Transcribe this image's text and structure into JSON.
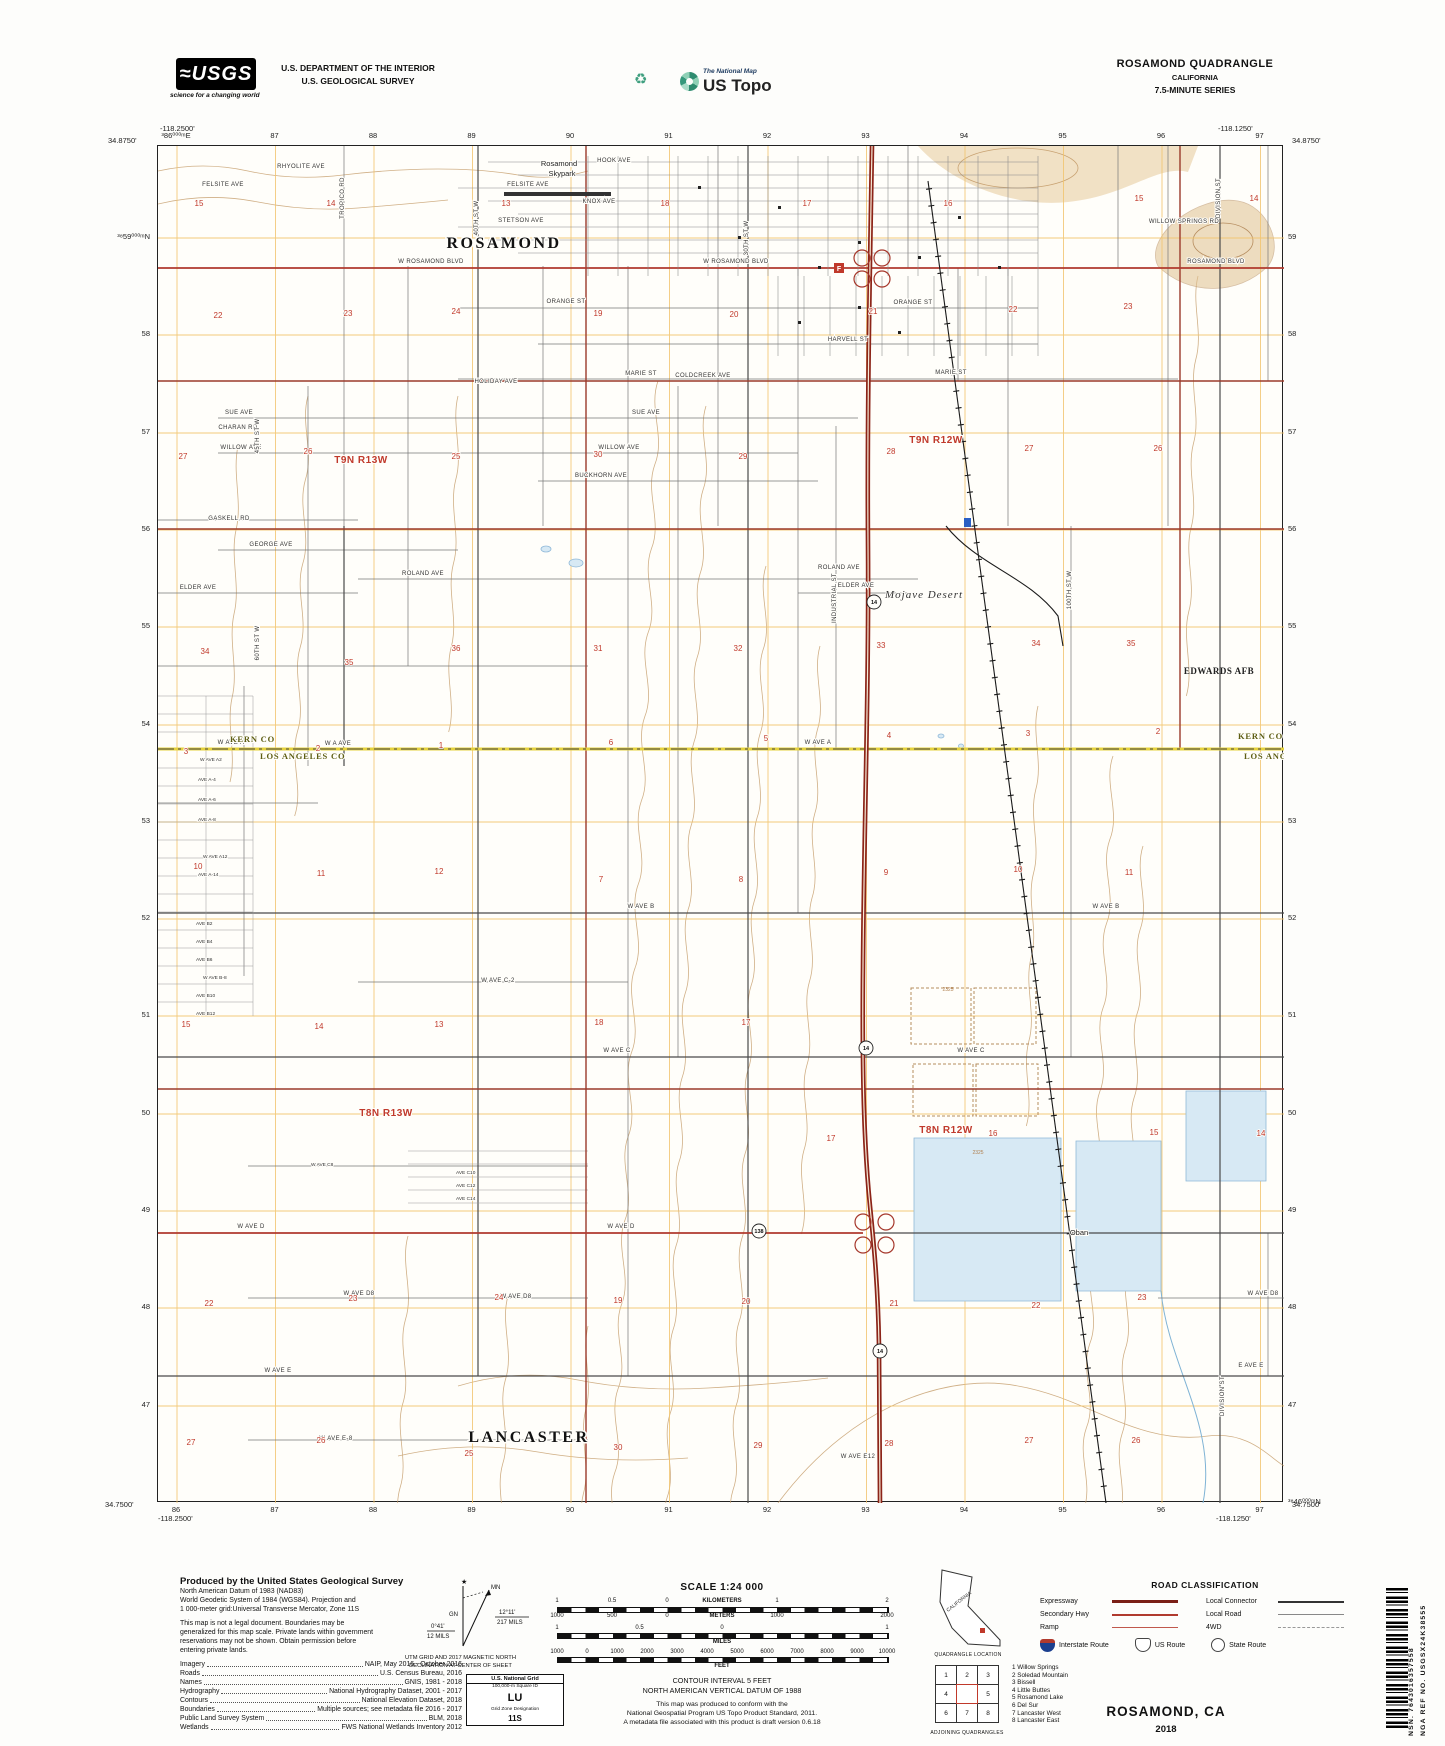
{
  "header": {
    "usgs_logo": "≈USGS",
    "usgs_tagline": "science for a changing world",
    "dept_line1": "U.S. DEPARTMENT OF THE INTERIOR",
    "dept_line2": "U.S. GEOLOGICAL SURVEY",
    "recycle_icon": "♻",
    "natmap_small": "The National Map",
    "natmap_big": "US Topo",
    "quad_title": "ROSAMOND QUADRANGLE",
    "quad_state": "CALIFORNIA",
    "quad_series": "7.5-MINUTE SERIES"
  },
  "map": {
    "corners": {
      "tl_lon": "-118.2500'",
      "tl_lat": "34.8750'",
      "tr_lon": "-118.1250'",
      "tr_lat": "34.8750'",
      "bl_lat": "34.7500'",
      "bl_lon": "-118.2500'",
      "br_lat": "34.7500'",
      "br_lon": "-118.1250'"
    },
    "grid_top": [
      "³86⁰⁰⁰ᵐE",
      "87",
      "88",
      "89",
      "90",
      "91",
      "92",
      "93",
      "94",
      "95",
      "96",
      "97"
    ],
    "grid_bottom": [
      "86",
      "87",
      "88",
      "89",
      "90",
      "91",
      "92",
      "93",
      "94",
      "95",
      "96",
      "97"
    ],
    "grid_left": [
      "³⁸59⁰⁰⁰ᵐN",
      "58",
      "57",
      "56",
      "55",
      "54",
      "53",
      "52",
      "51",
      "50",
      "49",
      "48",
      "47"
    ],
    "grid_right": [
      "59",
      "58",
      "57",
      "56",
      "55",
      "54",
      "53",
      "52",
      "51",
      "50",
      "49",
      "48",
      "47",
      "³⁸46⁰⁰⁰ᵐN"
    ],
    "colors": {
      "highway": "#8c2418",
      "secondary_road": "#b03a2e",
      "county_line": "#e6d23c",
      "water": "#d7e9f4",
      "contour": "#c8a272",
      "utm_grid": "#f2c46d",
      "section_number": "#c0392b"
    },
    "labels": [
      {
        "t": "HOOK AVE",
        "x": 456,
        "y": 16,
        "c": "street"
      },
      {
        "t": "RHYOLITE AVE",
        "x": 143,
        "y": 22,
        "c": "street"
      },
      {
        "t": "FELSITE AVE",
        "x": 65,
        "y": 40,
        "c": "street"
      },
      {
        "t": "FELSITE AVE",
        "x": 370,
        "y": 40,
        "c": "street"
      },
      {
        "t": "KNOX AVE",
        "x": 441,
        "y": 57,
        "c": "street"
      },
      {
        "t": "STETSON AVE",
        "x": 363,
        "y": 76,
        "c": "street"
      },
      {
        "t": "W ROSAMOND BLVD",
        "x": 273,
        "y": 117,
        "c": "street"
      },
      {
        "t": "W ROSAMOND BLVD",
        "x": 578,
        "y": 117,
        "c": "street"
      },
      {
        "t": "ROSAMOND BLVD",
        "x": 1058,
        "y": 117,
        "c": "street"
      },
      {
        "t": "WILLOW SPRINGS RD",
        "x": 1026,
        "y": 77,
        "c": "street"
      },
      {
        "t": "ORANGE ST",
        "x": 408,
        "y": 157,
        "c": "street"
      },
      {
        "t": "ORANGE ST",
        "x": 755,
        "y": 158,
        "c": "street"
      },
      {
        "t": "MARIE ST",
        "x": 483,
        "y": 229,
        "c": "street"
      },
      {
        "t": "MARIE ST",
        "x": 793,
        "y": 228,
        "c": "street"
      },
      {
        "t": "HOLIDAY AVE",
        "x": 338,
        "y": 237,
        "c": "street"
      },
      {
        "t": "COLDCREEK AVE",
        "x": 545,
        "y": 231,
        "c": "street"
      },
      {
        "t": "HARVELL ST",
        "x": 690,
        "y": 195,
        "c": "street"
      },
      {
        "t": "SUE AVE",
        "x": 81,
        "y": 268,
        "c": "street"
      },
      {
        "t": "SUE AVE",
        "x": 488,
        "y": 268,
        "c": "street"
      },
      {
        "t": "CHARAN RD",
        "x": 80,
        "y": 283,
        "c": "street"
      },
      {
        "t": "WILLOW AVE",
        "x": 83,
        "y": 303,
        "c": "street"
      },
      {
        "t": "WILLOW AVE",
        "x": 461,
        "y": 303,
        "c": "street"
      },
      {
        "t": "BUCKHORN AVE",
        "x": 443,
        "y": 331,
        "c": "street"
      },
      {
        "t": "GASKELL RD",
        "x": 71,
        "y": 374,
        "c": "street"
      },
      {
        "t": "GEORGE AVE",
        "x": 113,
        "y": 400,
        "c": "street"
      },
      {
        "t": "ROLAND AVE",
        "x": 265,
        "y": 429,
        "c": "street"
      },
      {
        "t": "ROLAND AVE",
        "x": 681,
        "y": 423,
        "c": "street"
      },
      {
        "t": "ELDER AVE",
        "x": 40,
        "y": 443,
        "c": "street"
      },
      {
        "t": "ELDER AVE",
        "x": 698,
        "y": 441,
        "c": "street"
      },
      {
        "t": "W AVE A",
        "x": 73,
        "y": 598,
        "c": "street"
      },
      {
        "t": "W A AVE",
        "x": 180,
        "y": 599,
        "c": "street"
      },
      {
        "t": "W AVE A",
        "x": 660,
        "y": 598,
        "c": "street"
      },
      {
        "t": "W AVE B",
        "x": 483,
        "y": 762,
        "c": "street"
      },
      {
        "t": "W AVE B",
        "x": 948,
        "y": 762,
        "c": "street"
      },
      {
        "t": "W AVE C",
        "x": 459,
        "y": 906,
        "c": "street"
      },
      {
        "t": "W AVE C",
        "x": 813,
        "y": 906,
        "c": "street"
      },
      {
        "t": "W AVE C-2",
        "x": 340,
        "y": 836,
        "c": "street"
      },
      {
        "t": "W AVE D",
        "x": 93,
        "y": 1082,
        "c": "street"
      },
      {
        "t": "W AVE D",
        "x": 463,
        "y": 1082,
        "c": "street"
      },
      {
        "t": "W AVE D8",
        "x": 201,
        "y": 1149,
        "c": "street"
      },
      {
        "t": "W AVE D8",
        "x": 358,
        "y": 1152,
        "c": "street"
      },
      {
        "t": "W AVE D8",
        "x": 1105,
        "y": 1149,
        "c": "street"
      },
      {
        "t": "W AVE E",
        "x": 120,
        "y": 1226,
        "c": "street"
      },
      {
        "t": "E AVE E",
        "x": 1093,
        "y": 1221,
        "c": "street"
      },
      {
        "t": "W AVE E-8",
        "x": 178,
        "y": 1294,
        "c": "street"
      },
      {
        "t": "W AVE E12",
        "x": 700,
        "y": 1312,
        "c": "street"
      },
      {
        "t": "TROPICO RD",
        "x": 186,
        "y": 52,
        "c": "streetv"
      },
      {
        "t": "40TH ST W",
        "x": 320,
        "y": 72,
        "c": "streetv"
      },
      {
        "t": "30TH ST W",
        "x": 590,
        "y": 92,
        "c": "streetv"
      },
      {
        "t": "45TH ST W",
        "x": 101,
        "y": 290,
        "c": "streetv"
      },
      {
        "t": "60TH ST W",
        "x": 101,
        "y": 497,
        "c": "streetv"
      },
      {
        "t": "INDUSTRIAL ST",
        "x": 678,
        "y": 452,
        "c": "streetv"
      },
      {
        "t": "100TH ST W",
        "x": 913,
        "y": 444,
        "c": "streetv"
      },
      {
        "t": "DIVISION ST",
        "x": 1062,
        "y": 52,
        "c": "streetv"
      },
      {
        "t": "DIVISION ST",
        "x": 1066,
        "y": 1250,
        "c": "streetv"
      },
      {
        "t": "ROSAMOND",
        "x": 346,
        "y": 102,
        "c": "town"
      },
      {
        "t": "LANCASTER",
        "x": 371,
        "y": 1296,
        "c": "town"
      },
      {
        "t": "Rosamond",
        "x": 401,
        "y": 20,
        "c": "place"
      },
      {
        "t": "Skypark",
        "x": 404,
        "y": 30,
        "c": "place"
      },
      {
        "t": "Oban",
        "x": 921,
        "y": 1089,
        "c": "place"
      },
      {
        "t": "Mojave Desert",
        "x": 766,
        "y": 452,
        "c": "desert"
      },
      {
        "t": "EDWARDS AFB",
        "x": 1061,
        "y": 528,
        "c": "afb"
      },
      {
        "t": "KERN CO",
        "x": 72,
        "y": 596,
        "c": "county"
      },
      {
        "t": "LOS ANGELES CO",
        "x": 102,
        "y": 613,
        "c": "county"
      },
      {
        "t": "KERN CO",
        "x": 1080,
        "y": 593,
        "c": "county"
      },
      {
        "t": "LOS ANGELES CO",
        "x": 1086,
        "y": 613,
        "c": "county"
      },
      {
        "t": "T9N R13W",
        "x": 203,
        "y": 317,
        "c": "twnshp"
      },
      {
        "t": "T9N R12W",
        "x": 778,
        "y": 297,
        "c": "twnshp"
      },
      {
        "t": "T8N R13W",
        "x": 228,
        "y": 970,
        "c": "twnshp"
      },
      {
        "t": "T8N R12W",
        "x": 788,
        "y": 987,
        "c": "twnshp"
      },
      {
        "t": "W AVE A2",
        "x": 42,
        "y": 615,
        "c": "sub"
      },
      {
        "t": "AVE A-4",
        "x": 40,
        "y": 635,
        "c": "sub"
      },
      {
        "t": "AVE A-6",
        "x": 40,
        "y": 655,
        "c": "sub"
      },
      {
        "t": "AVE A-8",
        "x": 40,
        "y": 675,
        "c": "sub"
      },
      {
        "t": "W AVE A12",
        "x": 45,
        "y": 712,
        "c": "sub"
      },
      {
        "t": "AVE A-14",
        "x": 40,
        "y": 730,
        "c": "sub"
      },
      {
        "t": "AVE B2",
        "x": 38,
        "y": 779,
        "c": "sub"
      },
      {
        "t": "AVE B4",
        "x": 38,
        "y": 797,
        "c": "sub"
      },
      {
        "t": "AVE B6",
        "x": 38,
        "y": 815,
        "c": "sub"
      },
      {
        "t": "W AVE B-8",
        "x": 45,
        "y": 833,
        "c": "sub"
      },
      {
        "t": "AVE B10",
        "x": 38,
        "y": 851,
        "c": "sub"
      },
      {
        "t": "AVE B12",
        "x": 38,
        "y": 869,
        "c": "sub"
      },
      {
        "t": "W AVE C8",
        "x": 153,
        "y": 1020,
        "c": "sub"
      },
      {
        "t": "AVE C10",
        "x": 298,
        "y": 1028,
        "c": "sub"
      },
      {
        "t": "AVE C12",
        "x": 298,
        "y": 1041,
        "c": "sub"
      },
      {
        "t": "AVE C14",
        "x": 298,
        "y": 1054,
        "c": "sub"
      },
      {
        "t": "2325",
        "x": 790,
        "y": 845,
        "c": "contour"
      },
      {
        "t": "2325",
        "x": 820,
        "y": 1008,
        "c": "contour"
      }
    ],
    "sections": [
      [
        15,
        41,
        60
      ],
      [
        14,
        173,
        60
      ],
      [
        13,
        348,
        60
      ],
      [
        18,
        507,
        60
      ],
      [
        17,
        649,
        60
      ],
      [
        16,
        790,
        60
      ],
      [
        15,
        981,
        55
      ],
      [
        14,
        1096,
        55
      ],
      [
        22,
        60,
        172
      ],
      [
        23,
        190,
        170
      ],
      [
        24,
        298,
        168
      ],
      [
        19,
        440,
        170
      ],
      [
        20,
        576,
        171
      ],
      [
        21,
        715,
        168
      ],
      [
        22,
        855,
        166
      ],
      [
        23,
        970,
        163
      ],
      [
        27,
        25,
        313
      ],
      [
        26,
        150,
        308
      ],
      [
        25,
        298,
        313
      ],
      [
        30,
        440,
        311
      ],
      [
        29,
        585,
        313
      ],
      [
        28,
        733,
        308
      ],
      [
        27,
        871,
        305
      ],
      [
        26,
        1000,
        305
      ],
      [
        34,
        47,
        508
      ],
      [
        35,
        191,
        519
      ],
      [
        36,
        298,
        505
      ],
      [
        31,
        440,
        505
      ],
      [
        32,
        580,
        505
      ],
      [
        33,
        723,
        502
      ],
      [
        34,
        878,
        500
      ],
      [
        35,
        973,
        500
      ],
      [
        3,
        28,
        608
      ],
      [
        2,
        160,
        605
      ],
      [
        1,
        283,
        602
      ],
      [
        6,
        453,
        599
      ],
      [
        5,
        608,
        595
      ],
      [
        4,
        731,
        592
      ],
      [
        3,
        870,
        590
      ],
      [
        2,
        1000,
        588
      ],
      [
        10,
        40,
        723
      ],
      [
        11,
        163,
        730
      ],
      [
        12,
        281,
        728
      ],
      [
        7,
        443,
        736
      ],
      [
        8,
        583,
        736
      ],
      [
        9,
        728,
        729
      ],
      [
        10,
        860,
        726
      ],
      [
        11,
        971,
        729
      ],
      [
        15,
        28,
        881
      ],
      [
        14,
        161,
        883
      ],
      [
        13,
        281,
        881
      ],
      [
        18,
        441,
        879
      ],
      [
        17,
        588,
        879
      ],
      [
        17,
        673,
        995
      ],
      [
        16,
        835,
        990
      ],
      [
        15,
        996,
        989
      ],
      [
        14,
        1103,
        990
      ],
      [
        22,
        51,
        1160
      ],
      [
        23,
        195,
        1155
      ],
      [
        24,
        341,
        1154
      ],
      [
        19,
        460,
        1157
      ],
      [
        20,
        588,
        1158
      ],
      [
        21,
        736,
        1160
      ],
      [
        22,
        878,
        1162
      ],
      [
        23,
        984,
        1154
      ],
      [
        27,
        33,
        1299
      ],
      [
        26,
        163,
        1297
      ],
      [
        25,
        311,
        1310
      ],
      [
        30,
        460,
        1304
      ],
      [
        29,
        600,
        1302
      ],
      [
        28,
        731,
        1300
      ],
      [
        27,
        871,
        1297
      ],
      [
        26,
        978,
        1297
      ]
    ],
    "shields": [
      {
        "t": "14",
        "x": 716,
        "y": 456,
        "k": "state"
      },
      {
        "t": "14",
        "x": 708,
        "y": 902,
        "k": "state"
      },
      {
        "t": "14",
        "x": 722,
        "y": 1205,
        "k": "state"
      },
      {
        "t": "138",
        "x": 601,
        "y": 1085,
        "k": "state"
      }
    ],
    "poi": {
      "post_office": "F"
    }
  },
  "footer": {
    "produced_heading": "Produced by the United States Geological Survey",
    "datum_lines": [
      "North American Datum of 1983 (NAD83)",
      "World Geodetic System of 1984 (WGS84).  Projection and",
      "1 000-meter grid:Universal Transverse Mercator, Zone 11S"
    ],
    "legal_lines": [
      "This map is not a legal document. Boundaries may be",
      "generalized for this map scale. Private lands within government",
      "reservations may not be shown. Obtain permission before",
      "entering private lands."
    ],
    "sources": [
      [
        "Imagery",
        "NAIP,  May  2016  -  October  2016"
      ],
      [
        "Roads",
        "U.S.  Census  Bureau,  2016"
      ],
      [
        "Names",
        "GNIS,  1981  -  2018"
      ],
      [
        "Hydrography",
        "National  Hydrography  Dataset,  2001  -  2017"
      ],
      [
        "Contours",
        "National  Elevation  Dataset,  2018"
      ],
      [
        "Boundaries",
        "Multiple  sources;  see  metadata  file  2016  -  2017"
      ],
      [
        "Public  Land  Survey  System",
        "BLM,  2018"
      ],
      [
        "Wetlands",
        "FWS  National  Wetlands  Inventory  2012"
      ]
    ],
    "declination": {
      "gn": "GN",
      "mn": "MN",
      "left_deg": "0°41'",
      "left_mils": "12 MILS",
      "right_deg": "12°11'",
      "right_mils": "217 MILS",
      "caption1": "UTM GRID AND 2017 MAGNETIC NORTH",
      "caption2": "DECLINATION AT CENTER OF SHEET"
    },
    "usng": {
      "title": "U.S. National Grid",
      "sq_label": "100,000-m Square ID",
      "sq": "LU",
      "zone_label": "Grid Zone Designation",
      "zone": "11S"
    },
    "scale": {
      "title": "SCALE 1:24 000",
      "km_label": "KILOMETERS",
      "km_ticks": [
        "1",
        "0.5",
        "0",
        "1",
        "2"
      ],
      "m_label": "METERS",
      "m_ticks": [
        "1000",
        "500",
        "0",
        "1000",
        "2000"
      ],
      "mi_label": "MILES",
      "mi_ticks": [
        "1",
        "0.5",
        "0",
        "1"
      ],
      "ft_label": "FEET",
      "ft_ticks": [
        "1000",
        "0",
        "1000",
        "2000",
        "3000",
        "4000",
        "5000",
        "6000",
        "7000",
        "8000",
        "9000",
        "10000"
      ]
    },
    "contour1": "CONTOUR INTERVAL 5 FEET",
    "contour2": "NORTH AMERICAN VERTICAL DATUM OF 1988",
    "conform": [
      "This map was produced to conform with the",
      "National Geospatial Program US Topo Product Standard, 2011.",
      "A metadata file associated with this product is draft version 0.6.18"
    ],
    "quad_loc": {
      "state": "CALIFORNIA",
      "caption": "QUADRANGLE LOCATION"
    },
    "road_class": {
      "title": "ROAD CLASSIFICATION",
      "left": [
        [
          "Expressway",
          "expwy"
        ],
        [
          "Secondary Hwy",
          "sec"
        ],
        [
          "Ramp",
          "ramp"
        ]
      ],
      "right": [
        [
          "Local Connector",
          "conn"
        ],
        [
          "Local Road",
          "local"
        ],
        [
          "4WD",
          "fwd"
        ]
      ],
      "shields": [
        [
          "Interstate Route",
          "interstate"
        ],
        [
          "US Route",
          "us"
        ],
        [
          "State Route",
          "state"
        ]
      ]
    },
    "adjoining": {
      "cells": [
        "1",
        "2",
        "3",
        "4",
        "",
        "5",
        "6",
        "7",
        "8"
      ],
      "caption": "ADJOINING QUADRANGLES",
      "list": [
        "1 Willow Springs",
        "2 Soledad Mountain",
        "3 Bissell",
        "4 Little Buttes",
        "5 Rosamond Lake",
        "6 Del Sur",
        "7 Lancaster West",
        "8 Lancaster East"
      ]
    },
    "title": "ROSAMOND,  CA",
    "year": "2018"
  },
  "barcode": {
    "nsn": "NSN.  7643016357558",
    "nga": "NGA REF NO.  USGSX24K38555"
  }
}
